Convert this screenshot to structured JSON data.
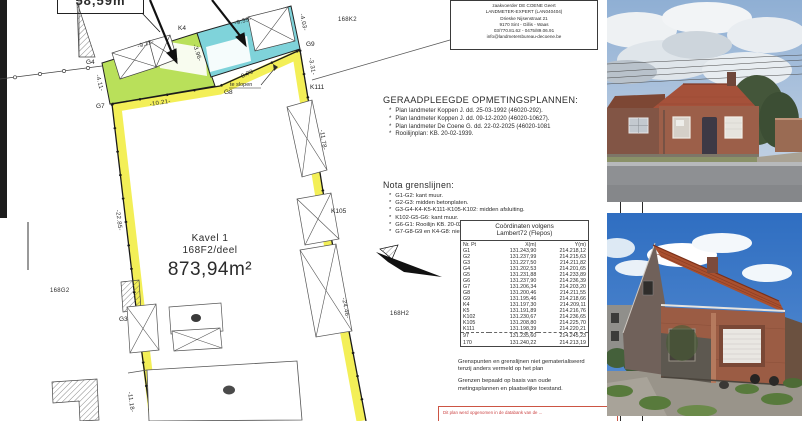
{
  "plan": {
    "area_box": "58,59m",
    "kavel": {
      "name": "Kavel 1",
      "lot": "168F2/deel",
      "area": "873,94m²"
    },
    "neighbors": {
      "k2": "168K2",
      "g2": "168G2",
      "h2": "168H2"
    },
    "points": {
      "g3": "G3",
      "g4": "G4",
      "g7": "G7",
      "g8": "G8",
      "g9": "G9",
      "k4": "K4",
      "k105": "K105",
      "k111": "K111"
    },
    "measurements": {
      "m911": "-9.11-",
      "m939": "-9.39-",
      "m396": "-3.96-",
      "m403": "-4.03-",
      "m411": "-4.11-",
      "m331": "-3.31-",
      "m870": "-8.70-",
      "m1021": "-10.21-",
      "m1118": "-11.18-",
      "m1178": "-11.78-",
      "m2285": "-22.85-",
      "m2446": "-24.46-"
    },
    "te_slopen": "te slopen",
    "surveyor": {
      "line1": "zaakvoerder DE COENE Geert",
      "line2": "LANDMETER-EXPERT (LAN040404)",
      "line3": "Drieske Nijsenstraat 21",
      "line4": "9170 Sint - Gillis - Waas",
      "line5": "03/770.81.62 - 0475/89.06.91",
      "line6": "info@landmetersbureau-decoene.be"
    },
    "consulted": {
      "title": "GERAADPLEEGDE OPMETINGSPLANNEN:",
      "items": [
        "Plan landmeter Koppen J. dd. 25-03-1992 (46020-292).",
        "Plan landmeter Koppen J. dd. 09-12-2020 (46020-10627).",
        "Plan landmeter De Coene G. dd. 22-02-2025 (46020-1081",
        "Rooilijnplan: KB. 20-02-1939."
      ]
    },
    "nota": {
      "title": "Nota grenslijnen:",
      "items": [
        "G1-G2: kant muur.",
        "G2-G3: midden betonplaten.",
        "G3-G4-K4-K5-K111-K105-K102: midden afsluiting.",
        "K102-G5-G6: kant muur.",
        "G6-G1: Rooilijn KB. 20-02-1939.",
        "G7-G8-G9 en K4-G8: nieuwe grenslijn."
      ]
    },
    "coords": {
      "title1": "Coördinaten volgens",
      "title2": "Lambert72 (Flepos)",
      "headers": [
        "Nr. Pt",
        "X(m)",
        "Y(m)"
      ],
      "rows": [
        [
          "G1",
          "131.243,90",
          "214.218,12"
        ],
        [
          "G2",
          "131.237,99",
          "214.215,63"
        ],
        [
          "G3",
          "131.227,50",
          "214.211,82"
        ],
        [
          "G4",
          "131.202,53",
          "214.201,65"
        ],
        [
          "G5",
          "131.231,88",
          "214.233,89"
        ],
        [
          "G6",
          "131.237,90",
          "214.236,39"
        ],
        [
          "G7",
          "131.206,34",
          "214.203,20"
        ],
        [
          "G8",
          "131.200,46",
          "214.211,55"
        ],
        [
          "G9",
          "131.195,46",
          "214.218,66"
        ],
        [
          "K4",
          "131.197,30",
          "214.209,11"
        ],
        [
          "K5",
          "131.191,89",
          "214.216,76"
        ],
        [
          "K102",
          "131.230,67",
          "214.236,65"
        ],
        [
          "K105",
          "131.208,80",
          "214.225,70"
        ],
        [
          "K111",
          "131.198,39",
          "214.220,21"
        ],
        [
          "97",
          "131.235,60",
          "214.245,23"
        ],
        [
          "170",
          "131.240,22",
          "214.213,19"
        ]
      ]
    },
    "notes": {
      "p1": "Grenspunten en grenslijnen niet gematerialiseerd tenzij anders vermeld op het plan",
      "p2": "Grenzen bepaald op basis van oude metingsplannen en plaatselijke toestand."
    },
    "red_notice": "Dit plan werd opgenomen in de databank van de ..."
  },
  "colors": {
    "parcel_highlight": "#f2ee4e",
    "building_keep_green": "#b9e05a",
    "building_demolish_cyan": "#7fd3da",
    "notice_red": "#cc4444"
  }
}
